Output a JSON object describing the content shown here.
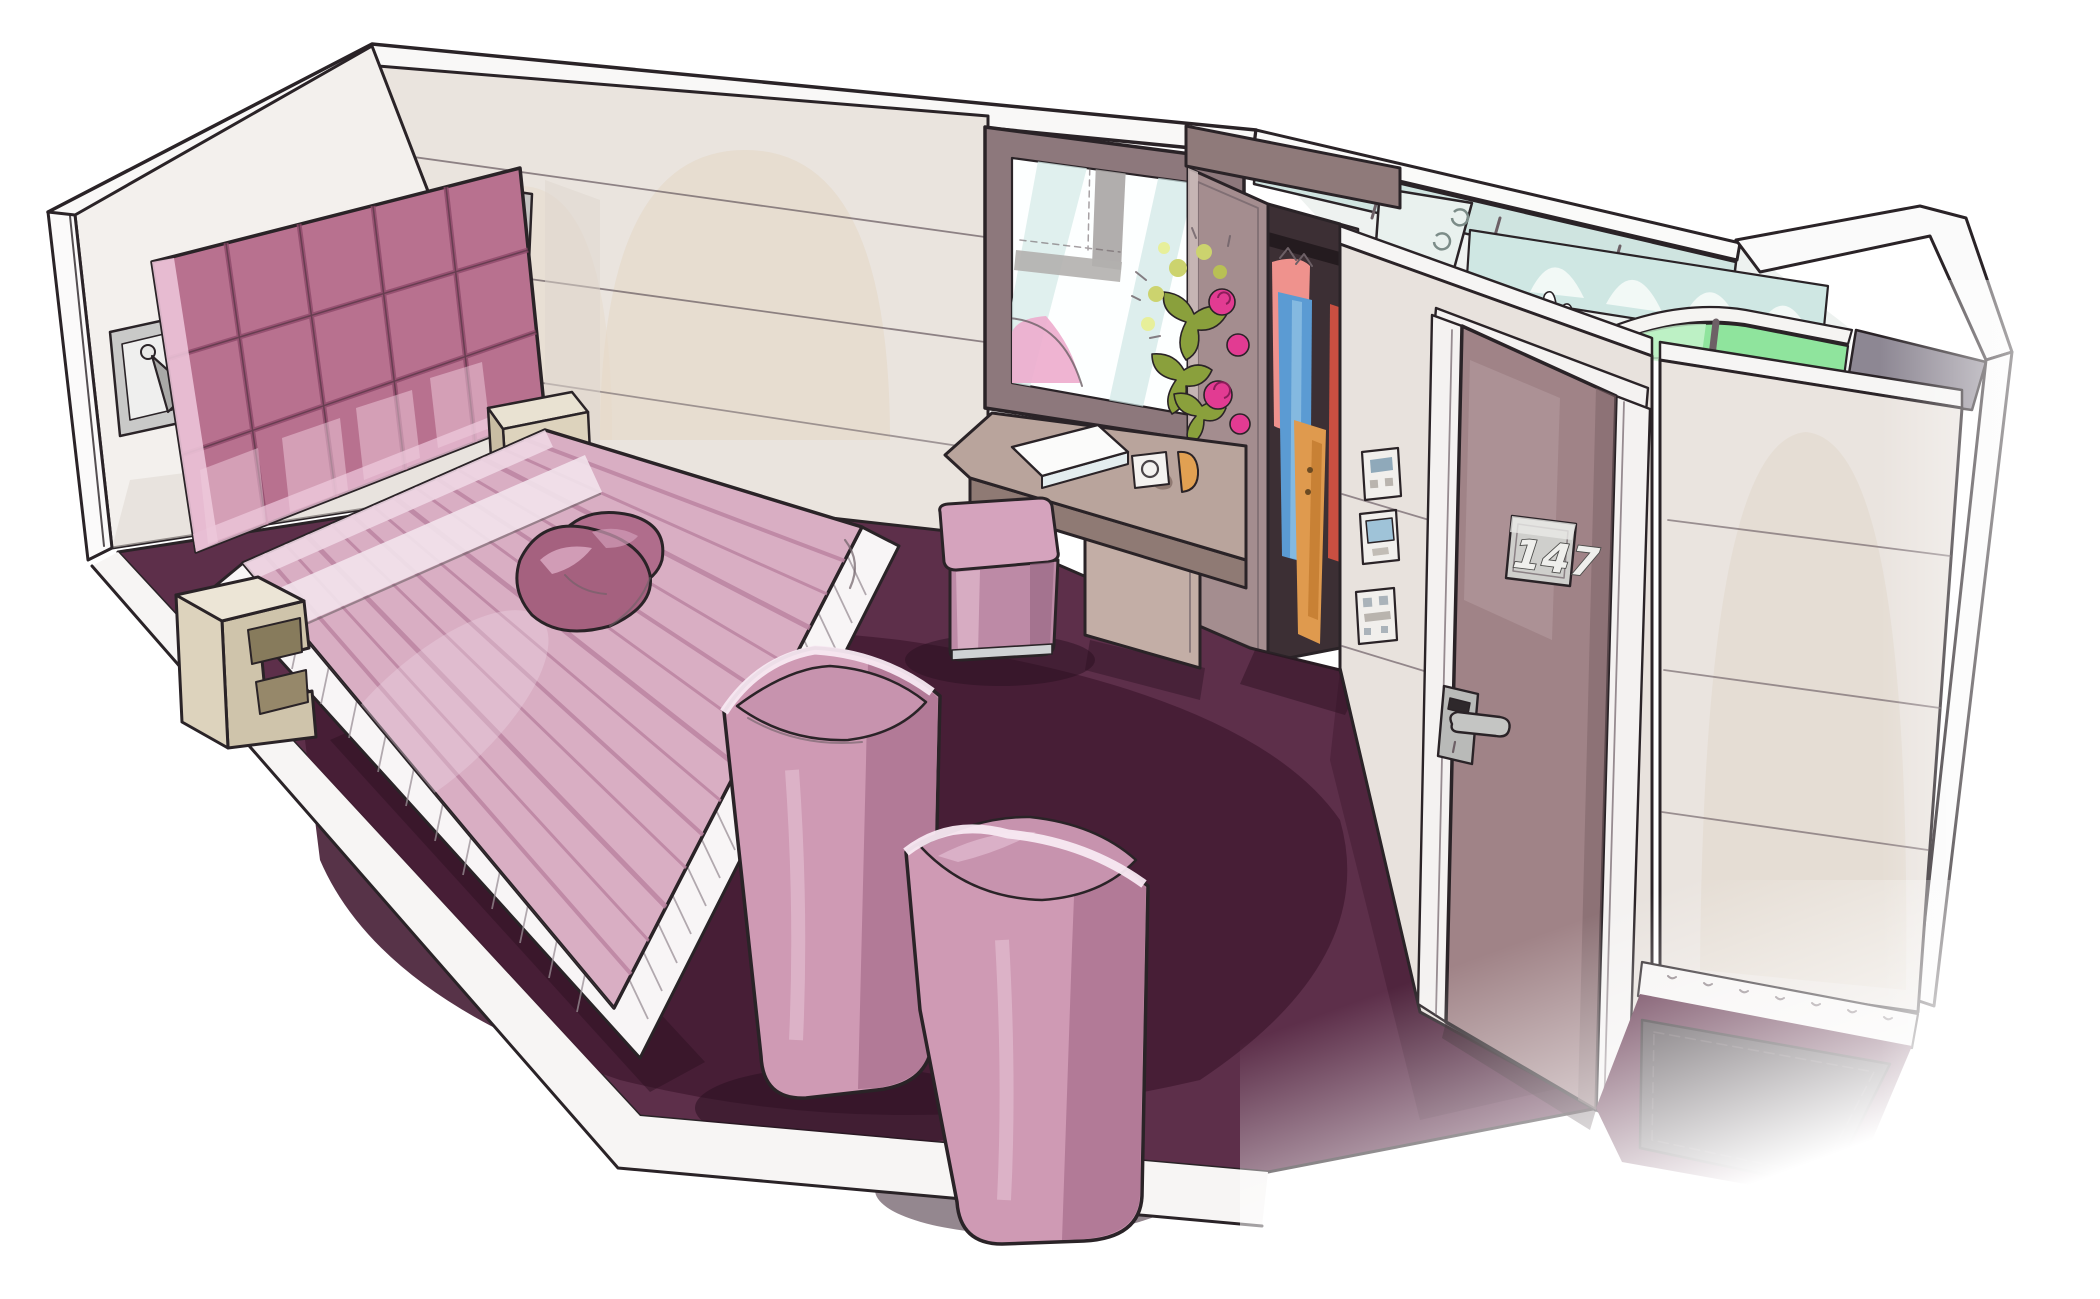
{
  "scene": {
    "type": "hand-drawn marker sketch",
    "subject": "hotel guest room 3D cutaway illustration",
    "view": "aerial cutaway perspective"
  },
  "door": {
    "room_number": "147"
  },
  "palette": {
    "ink": "#2a2327",
    "wall": "#eae4de",
    "wall_light": "#f3f0ed",
    "carpet": "#5d2f4a",
    "carpet_dark": "#451d34",
    "bed_pink": "#d9aec3",
    "bed_stripe": "#bb84a2",
    "headboard_rose": "#b8718f",
    "pillow_rose": "#a5617f",
    "armchair_pink": "#cf9ab4",
    "pouf_pink": "#d5a3bd",
    "furniture_cream": "#ddd3bd",
    "desk_taupe": "#b9a49c",
    "door_taupe": "#a08387",
    "wardrobe_taupe": "#a48d8f",
    "tile_aqua": "#cfe7e3",
    "shower_green": "#8fe49d",
    "clothes_salmon": "#ef928d",
    "clothes_blue": "#5b9bd3",
    "clothes_orange": "#df9a4e",
    "mat_gray": "#4a4247"
  },
  "objects": [
    "tufted rose headboard",
    "double bed with striped pink bedspread",
    "two satin throw pillows",
    "pleated white bed skirt",
    "zigzag cream nightstands",
    "metal wall reading lamps",
    "window with street view",
    "flower bouquet",
    "writing ledge with white notebook",
    "round socket plate",
    "pink cube pouf",
    "two pink tub armchairs",
    "open wardrobe with hanging clothes",
    "wall control panels",
    "entrance door number 147 with card-lock handle",
    "dark entry mat",
    "bathroom cube with aqua tiles and green shower glass",
    "deep plum carpet"
  ]
}
